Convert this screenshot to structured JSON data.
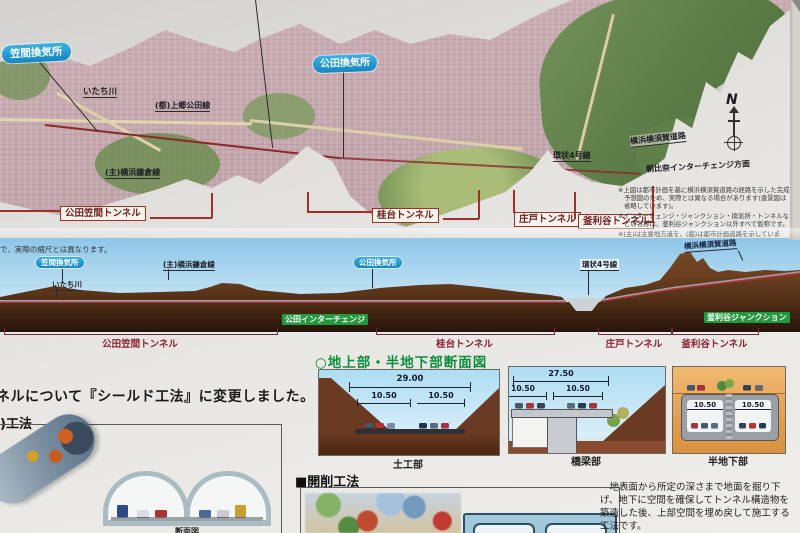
{
  "colors": {
    "vent_label_bg": "#1e9ad6",
    "red_label_border": "#a03028",
    "green_tag_bg": "#22993d",
    "heading_green": "#0c8f3c",
    "profile_sky": "#8ec6e8",
    "profile_earth": "#6b3f20",
    "map_urban": "#c7abb0",
    "map_forest": "#6d8c4f"
  },
  "map": {
    "vent_left": "笠間換気所",
    "vent_right": "公田換気所",
    "river": "いたち川",
    "road_kamigo_kuden": "(都)上郷公田線",
    "road_yokohama_kamakura": "(主)横浜鎌倉線",
    "road_kanjo4": "環状4号線",
    "road_yokoyoko": "横浜横須賀道路",
    "direction_asahina": "朝比奈インターチェンジ方面",
    "compass": "N",
    "tunnel_tags": [
      {
        "label": "公田笠間トンネル"
      },
      {
        "label": "桂台トンネル"
      },
      {
        "label": "庄戸トンネル"
      },
      {
        "label": "釜利谷トンネル"
      }
    ],
    "notes": [
      "※上図は都市計画を基に横浜横須賀道路の経路を示した完成予想図のため、実際とは異なる場合があります(遠景図は省略しています)。",
      "※インターチェンジ・ジャンクション・換気所・トンネルなどの名称は、釜利谷ジャンクション以外すべて仮称です。",
      "※(主)は主要地方道を、(都)は都市計画道路を示しています。"
    ]
  },
  "profile": {
    "scale_note": "で、実際の縮尺とは異なります。",
    "vent_left": "笠間換気所",
    "vent_right": "公田換気所",
    "river": "いたち川",
    "road_yokohama_kamakura": "(主)横浜鎌倉線",
    "road_kanjo4": "環状4号線",
    "road_yokoyoko": "横浜横須賀道路",
    "ic_tag": "公田インターチェンジ",
    "jct_tag": "釜利谷ジャンクション",
    "tunnels": [
      {
        "label": "公田笠間トンネル"
      },
      {
        "label": "桂台トンネル"
      },
      {
        "label": "庄戸トンネル"
      },
      {
        "label": "釜利谷トンネル"
      }
    ]
  },
  "sections": {
    "heading": "○地上部・半地下部断面図",
    "cards": [
      {
        "caption": "土工部",
        "overall": "29.00",
        "left": "10.50",
        "right": "10.50"
      },
      {
        "caption": "橋梁部",
        "overall": "27.50",
        "left": "10.50",
        "right": "10.50"
      },
      {
        "caption": "半地下部",
        "left": "10.50",
        "right": "10.50"
      }
    ]
  },
  "shield": {
    "headline": "ネルについて『シールド工法』に変更しました。",
    "subheading": ")工法",
    "caption": "断面図"
  },
  "cut_cover": {
    "heading": "■開削工法",
    "description": "　地表面から所定の深さまで地面を掘り下げ、地下に空間を確保してトンネル構造物を築造した後、上部空間を埋め戻して施工する工法です。"
  }
}
